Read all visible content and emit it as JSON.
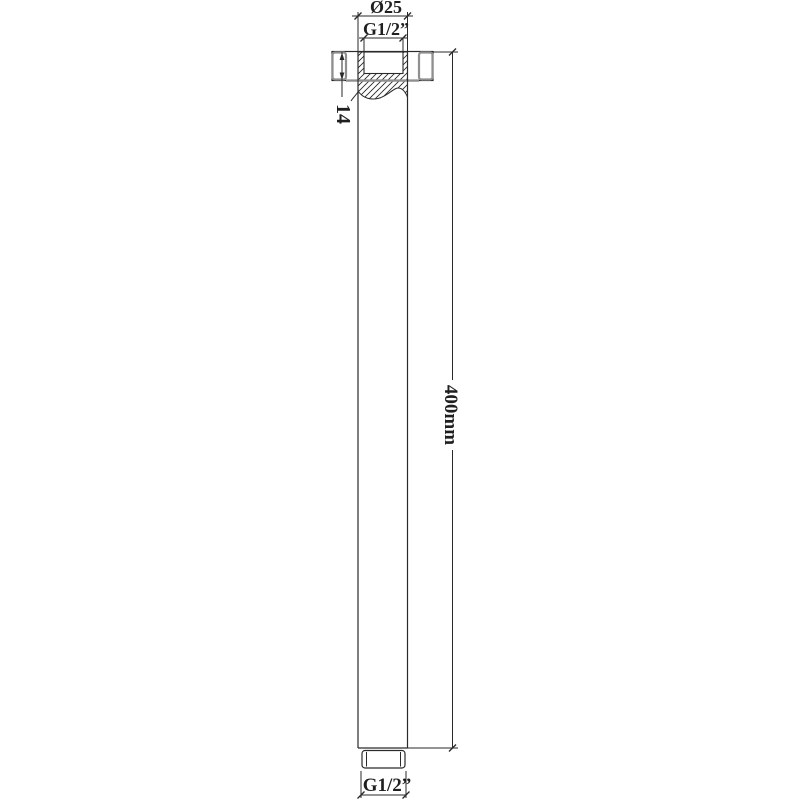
{
  "drawing": {
    "labels": {
      "top_diameter": "Ø25",
      "top_thread": "G1/2”",
      "flange_height": "14",
      "arm_length": "400mm",
      "bottom_thread": "G1/2”"
    },
    "colors": {
      "line": "#2a2a2a",
      "gray": "#8f8f8f",
      "background": "#ffffff"
    }
  }
}
